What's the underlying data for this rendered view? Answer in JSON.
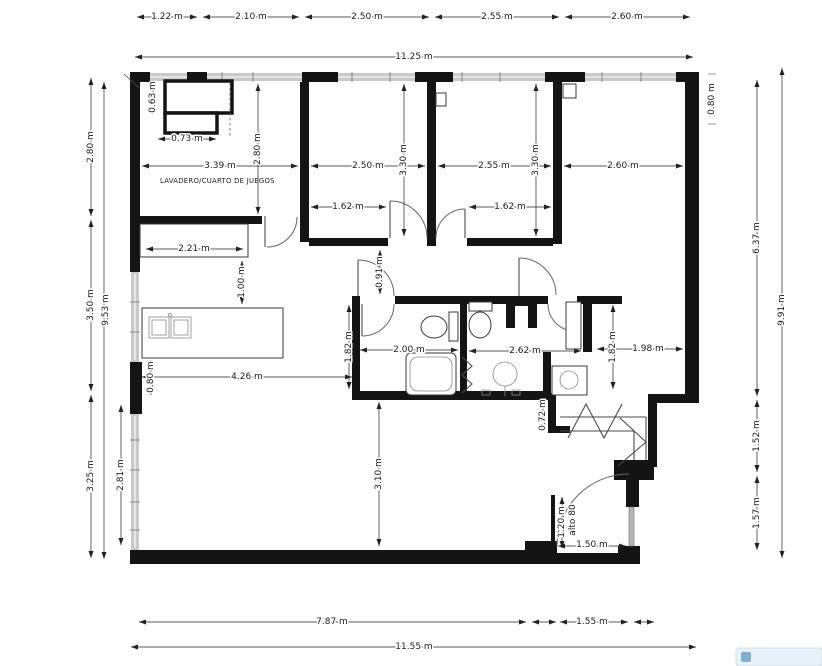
{
  "plan": {
    "room_labels": {
      "laundry_playroom": "LAVADERO/CUARTO DE JUEGOS"
    },
    "dimensions": {
      "top_segments": [
        "1.22 m",
        "2.10 m",
        "2.50 m",
        "2.55 m",
        "2.60 m"
      ],
      "top_total": "11.25 m",
      "bottom_segments": [
        "7.87 m",
        "1.55 m"
      ],
      "bottom_total": "11.55 m",
      "left_segments": [
        "2.80 m",
        "3.50 m",
        "3.25 m"
      ],
      "left_total": "9.53 m",
      "left_living": "2.81 m",
      "right_wall_top": "0.80 m",
      "right_segments": [
        "6.37 m",
        "1.52 m",
        "1.57 m"
      ],
      "right_total": "9.91 m",
      "laundry_width": "3.39 m",
      "laundry_height": "2.80 m",
      "laundry_unit_height": "0.63 m",
      "laundry_unit_width": "0.73 m",
      "counter_width": "2.21 m",
      "counter_island_gap": "1.00 m",
      "bedroom1_width": "2.50 m",
      "bedroom1_height": "3.30 m",
      "bedroom1_wall": "1.62 m",
      "bedroom2_width": "2.55 m",
      "bedroom2_height": "3.30 m",
      "bedroom2_wall": "1.62 m",
      "bedroom3_width": "2.60 m",
      "hallway_width": "0.91 m",
      "island_length": "4.26 m",
      "island_offset": "0.80 m",
      "bath1_width": "2.00 m",
      "bath1_depth": "1.82 m",
      "bath2_width": "2.62 m",
      "utility_depth": "1.82 m",
      "utility_width": "1.98 m",
      "stair_wall": "0.72 m",
      "living_depth": "3.10 m",
      "half_wall_height": "1.20 m",
      "half_wall_note": "alto 80",
      "entry_width": "1.50 m"
    }
  }
}
